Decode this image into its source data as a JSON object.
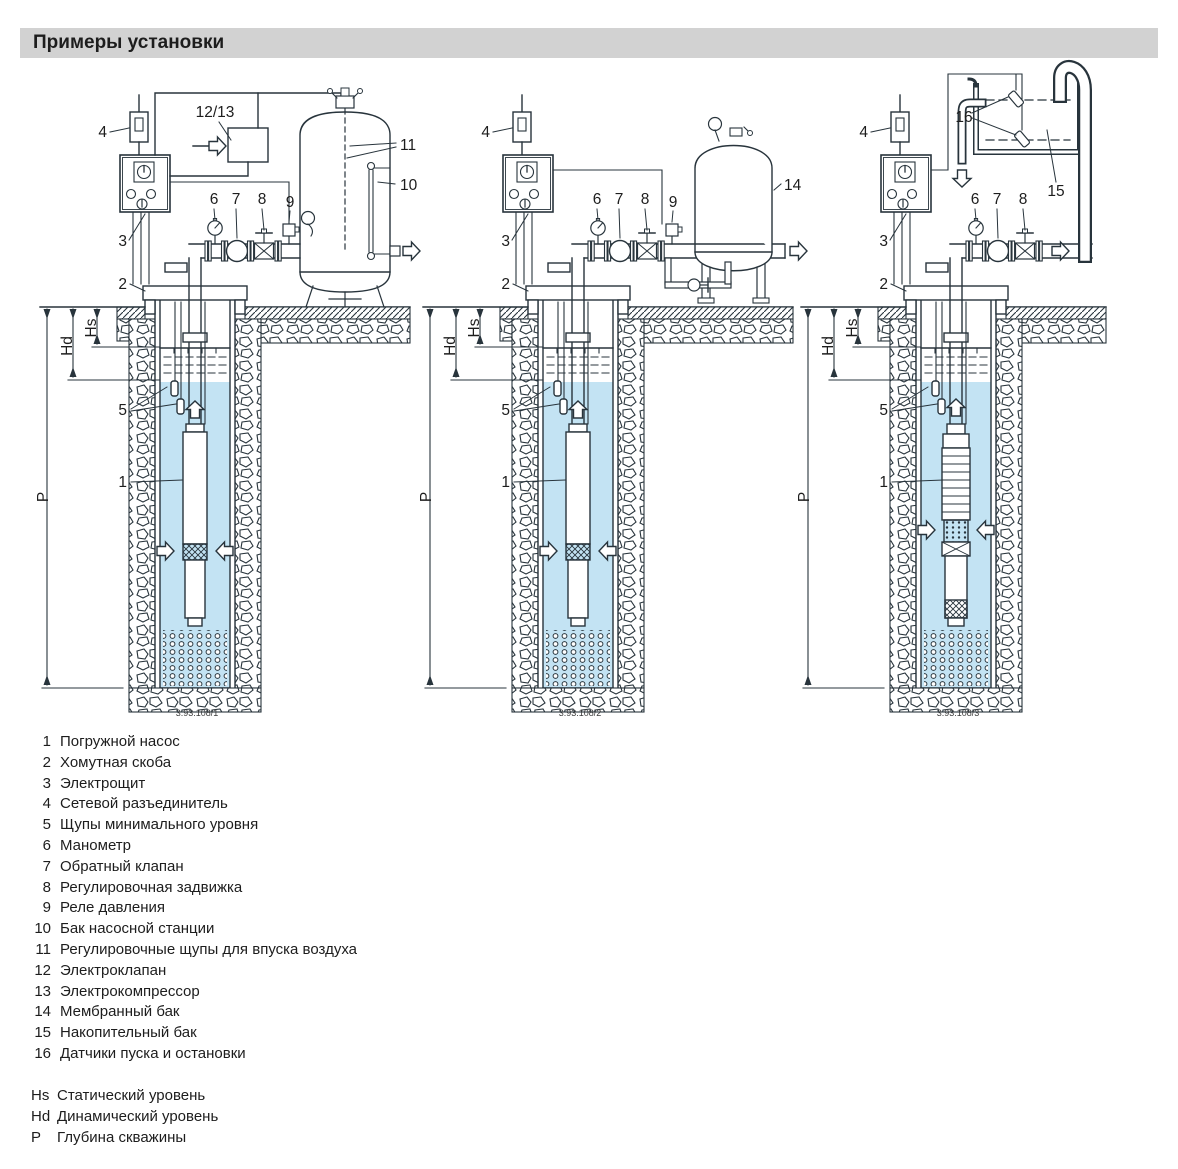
{
  "page": {
    "title": "Примеры установки"
  },
  "figures": [
    {
      "caption": "3.93.108/1",
      "labels": {
        "n1": "1",
        "n2": "2",
        "n3": "3",
        "n4": "4",
        "n5": "5",
        "n6": "6",
        "n7": "7",
        "n8": "8",
        "n9": "9",
        "n10": "10",
        "n11": "11",
        "n1213": "12/13",
        "hs": "Hs",
        "hd": "Hd",
        "p": "P"
      }
    },
    {
      "caption": "3.93.108/2",
      "labels": {
        "n1": "1",
        "n2": "2",
        "n3": "3",
        "n4": "4",
        "n5": "5",
        "n6": "6",
        "n7": "7",
        "n8": "8",
        "n9": "9",
        "n14": "14",
        "hs": "Hs",
        "hd": "Hd",
        "p": "P"
      }
    },
    {
      "caption": "3.93.108/3",
      "labels": {
        "n1": "1",
        "n2": "2",
        "n3": "3",
        "n4": "4",
        "n5": "5",
        "n6": "6",
        "n7": "7",
        "n8": "8",
        "n15": "15",
        "n16": "16",
        "hs": "Hs",
        "hd": "Hd",
        "p": "P"
      }
    }
  ],
  "legend": {
    "items": [
      {
        "num": "1",
        "text": "Погружной насос"
      },
      {
        "num": "2",
        "text": "Хомутная скоба"
      },
      {
        "num": "3",
        "text": "Электрощит"
      },
      {
        "num": "4",
        "text": "Сетевой разъединитель"
      },
      {
        "num": "5",
        "text": "Щупы минимального уровня"
      },
      {
        "num": "6",
        "text": "Манометр"
      },
      {
        "num": "7",
        "text": "Обратный клапан"
      },
      {
        "num": "8",
        "text": "Регулировочная задвижка"
      },
      {
        "num": "9",
        "text": "Реле давления"
      },
      {
        "num": "10",
        "text": "Бак насосной станции"
      },
      {
        "num": "11",
        "text": "Регулировочные щупы для впуска воздуха"
      },
      {
        "num": "12",
        "text": "Электроклапан"
      },
      {
        "num": "13",
        "text": "Электрокомпрессор"
      },
      {
        "num": "14",
        "text": "Мембранный бак"
      },
      {
        "num": "15",
        "text": "Накопительный бак"
      },
      {
        "num": "16",
        "text": "Датчики пуска и остановки"
      }
    ]
  },
  "notes": [
    {
      "key": "Hs",
      "text": "Статический уровень"
    },
    {
      "key": "Hd",
      "text": "Динамический уровень"
    },
    {
      "key": "P",
      "text": "Глубина скважины"
    }
  ],
  "colors": {
    "water": "#c3e3f3",
    "header_bg": "#d2d2d2",
    "line": "#28343c"
  }
}
